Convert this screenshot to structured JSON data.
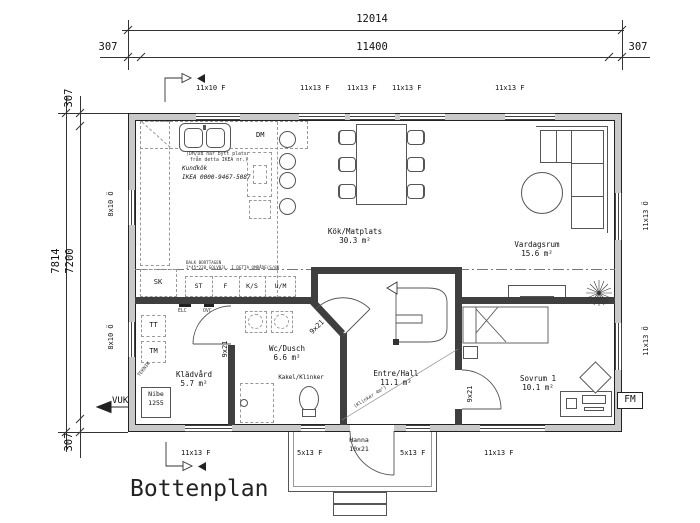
{
  "title": "Bottenplan",
  "dims": {
    "w_total": "12014",
    "w_inner": "11400",
    "w_off_l": "307",
    "w_off_r": "307",
    "h_total": "7814",
    "h_inner": "7200",
    "h_off_t": "307",
    "h_off_b": "307"
  },
  "openings": {
    "top": [
      "11x10 F",
      "11x13 F",
      "11x13 F",
      "11x13 F",
      "11x13 F"
    ],
    "bottom": [
      "11x13 F",
      "5x13 F",
      "5x13 F",
      "11x13 F"
    ],
    "left": [
      "8x10 Ö",
      "8x10 Ö"
    ],
    "right": [
      "11x13 Ö",
      "11x13 Ö"
    ],
    "entry_door_name": "Hanna",
    "entry_door_size": "10x21",
    "interior_door_size": "9x21"
  },
  "rooms": {
    "kitchen": {
      "name": "Kök/Matplats",
      "area": "30.3 m²"
    },
    "living": {
      "name": "Vardagsrum",
      "area": "15.6 m²"
    },
    "wc": {
      "name": "Wc/Dusch",
      "area": "6.6 m²",
      "floor": "Kakel/Klinker"
    },
    "laundry": {
      "name": "Klädvård",
      "area": "5.7 m²"
    },
    "hall": {
      "name": "Entre/Hall",
      "area": "11.1 m²",
      "floor_note": "(Klinker 4m²)"
    },
    "bedroom": {
      "name": "Sovrum 1",
      "area": "10.1 m²"
    }
  },
  "kitchen_notes": {
    "swap_1": "(DM/DB har bytt plats",
    "swap_2": "från detta IKEA nr.)",
    "brand": "Kundkök",
    "order": "IKEA 0000-9467-5087",
    "dm": "DM"
  },
  "beam_note": {
    "l1": "BALK BORTTAGEN",
    "l2": "2*45*220 GOLVBJL. I DETTA OMRÅDE(S/88"
  },
  "fixtures": {
    "sk": "SK",
    "st": "ST",
    "f": "F",
    "ks": "K/S",
    "um": "U/M",
    "elc": "ELC",
    "ovc": "OVC",
    "tt": "TT",
    "tm": "TM",
    "teknik": "TEKNIK",
    "heatpump_1": "Nibe",
    "heatpump_2": "1255"
  },
  "markers": {
    "vuk": "VUK",
    "fm": "FM"
  }
}
